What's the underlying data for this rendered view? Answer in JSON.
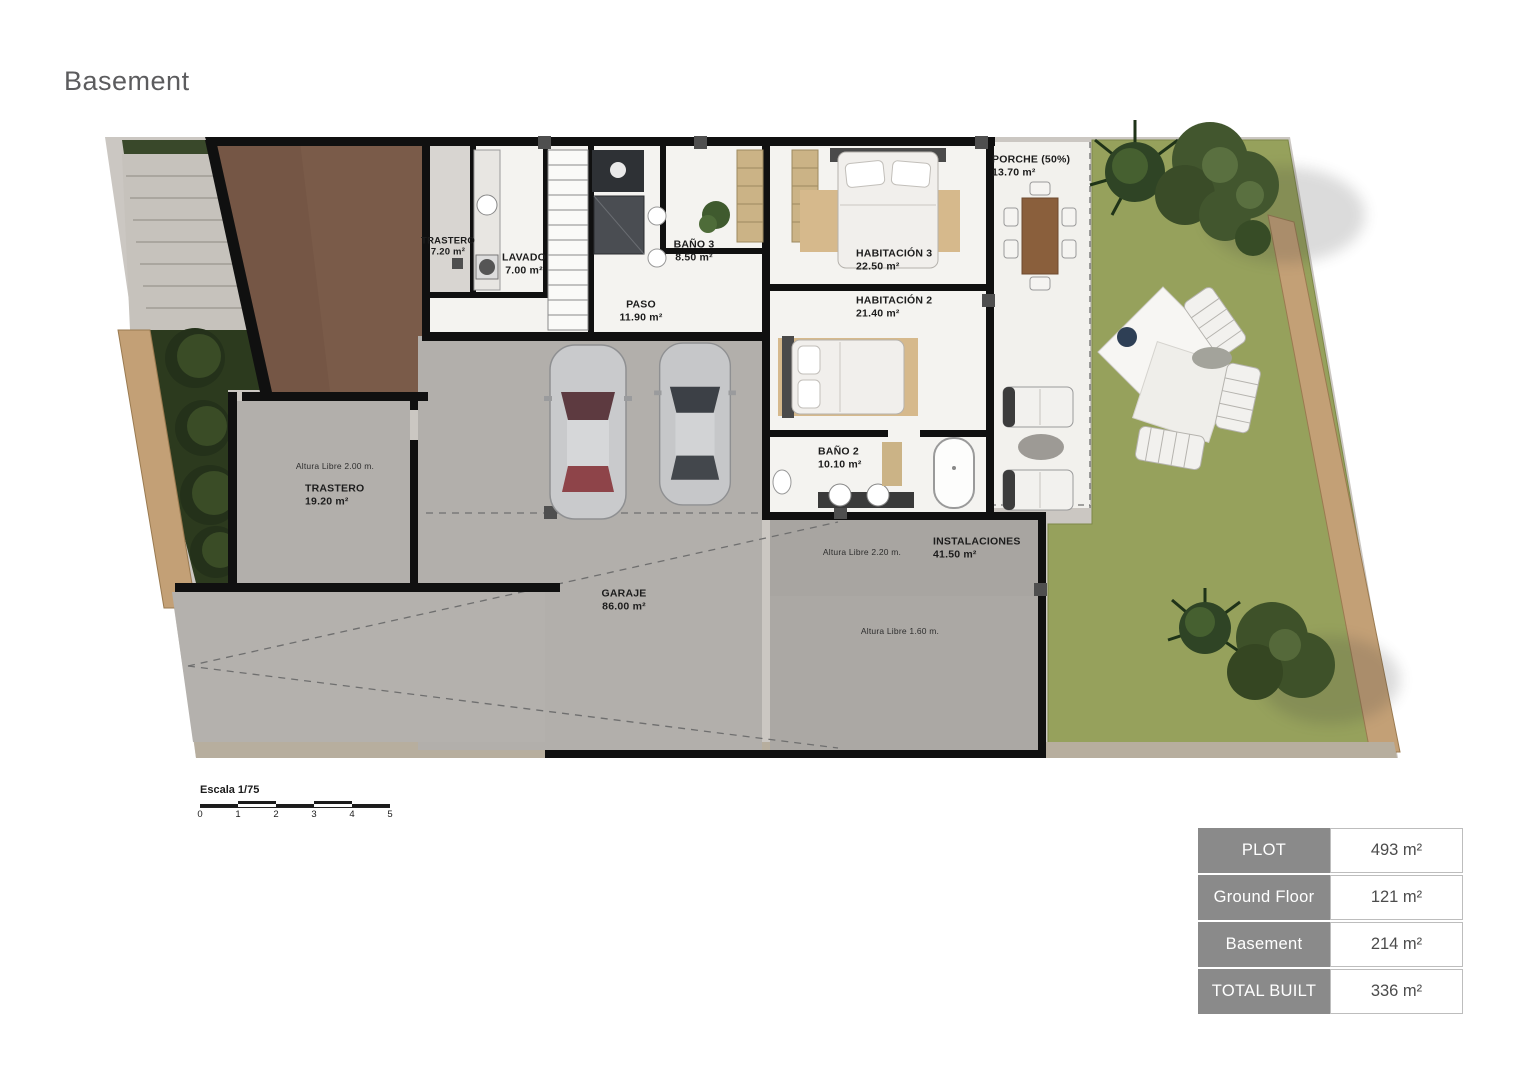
{
  "title": "Basement",
  "plan": {
    "rooms": [
      {
        "name": "TRASTERO",
        "area": "7.20 m²"
      },
      {
        "name": "LAVADO",
        "area": "7.00 m²"
      },
      {
        "name": "BAÑO 3",
        "area": "8.50 m²"
      },
      {
        "name": "PASO",
        "area": "11.90 m²"
      },
      {
        "name": "HABITACIÓN  3",
        "area": "22.50 m²"
      },
      {
        "name": "HABITACIÓN  2",
        "area": "21.40 m²"
      },
      {
        "name": "PORCHE (50%)",
        "area": "13.70 m²"
      },
      {
        "name": "BAÑO 2",
        "area": "10.10 m²"
      },
      {
        "name": "TRASTERO",
        "area": "19.20 m²"
      },
      {
        "name": "GARAJE",
        "area": "86.00 m²"
      },
      {
        "name": "INSTALACIONES",
        "area": "41.50 m²"
      }
    ],
    "annotations": [
      "Altura Libre 2.00 m.",
      "Altura Libre 2.20 m.",
      "Altura Libre 1.60 m."
    ],
    "scale": {
      "label": "Escala 1/75",
      "ticks": [
        "0",
        "1",
        "2",
        "3",
        "4",
        "5"
      ]
    }
  },
  "summary_table": {
    "rows": [
      {
        "label": "PLOT",
        "value": "493 m²"
      },
      {
        "label": "Ground Floor",
        "value": "121 m²"
      },
      {
        "label": "Basement",
        "value": "214 m²"
      },
      {
        "label": "TOTAL BUILT",
        "value": "336 m²"
      }
    ]
  },
  "colors": {
    "wall": "#101010",
    "room_white": "#f4f3f0",
    "garage_gray": "#b2afab",
    "instalaciones_gray": "#a8a5a1",
    "lawn_green": "#96a15c",
    "garden_dark_green": "#2c3a1e",
    "dirt_brown": "#7a5b49",
    "stone_path_tan": "#c3a076",
    "concrete": "#cbc7c2",
    "table_header_bg": "#8a8a8a",
    "title_gray": "#5c5c5e"
  }
}
